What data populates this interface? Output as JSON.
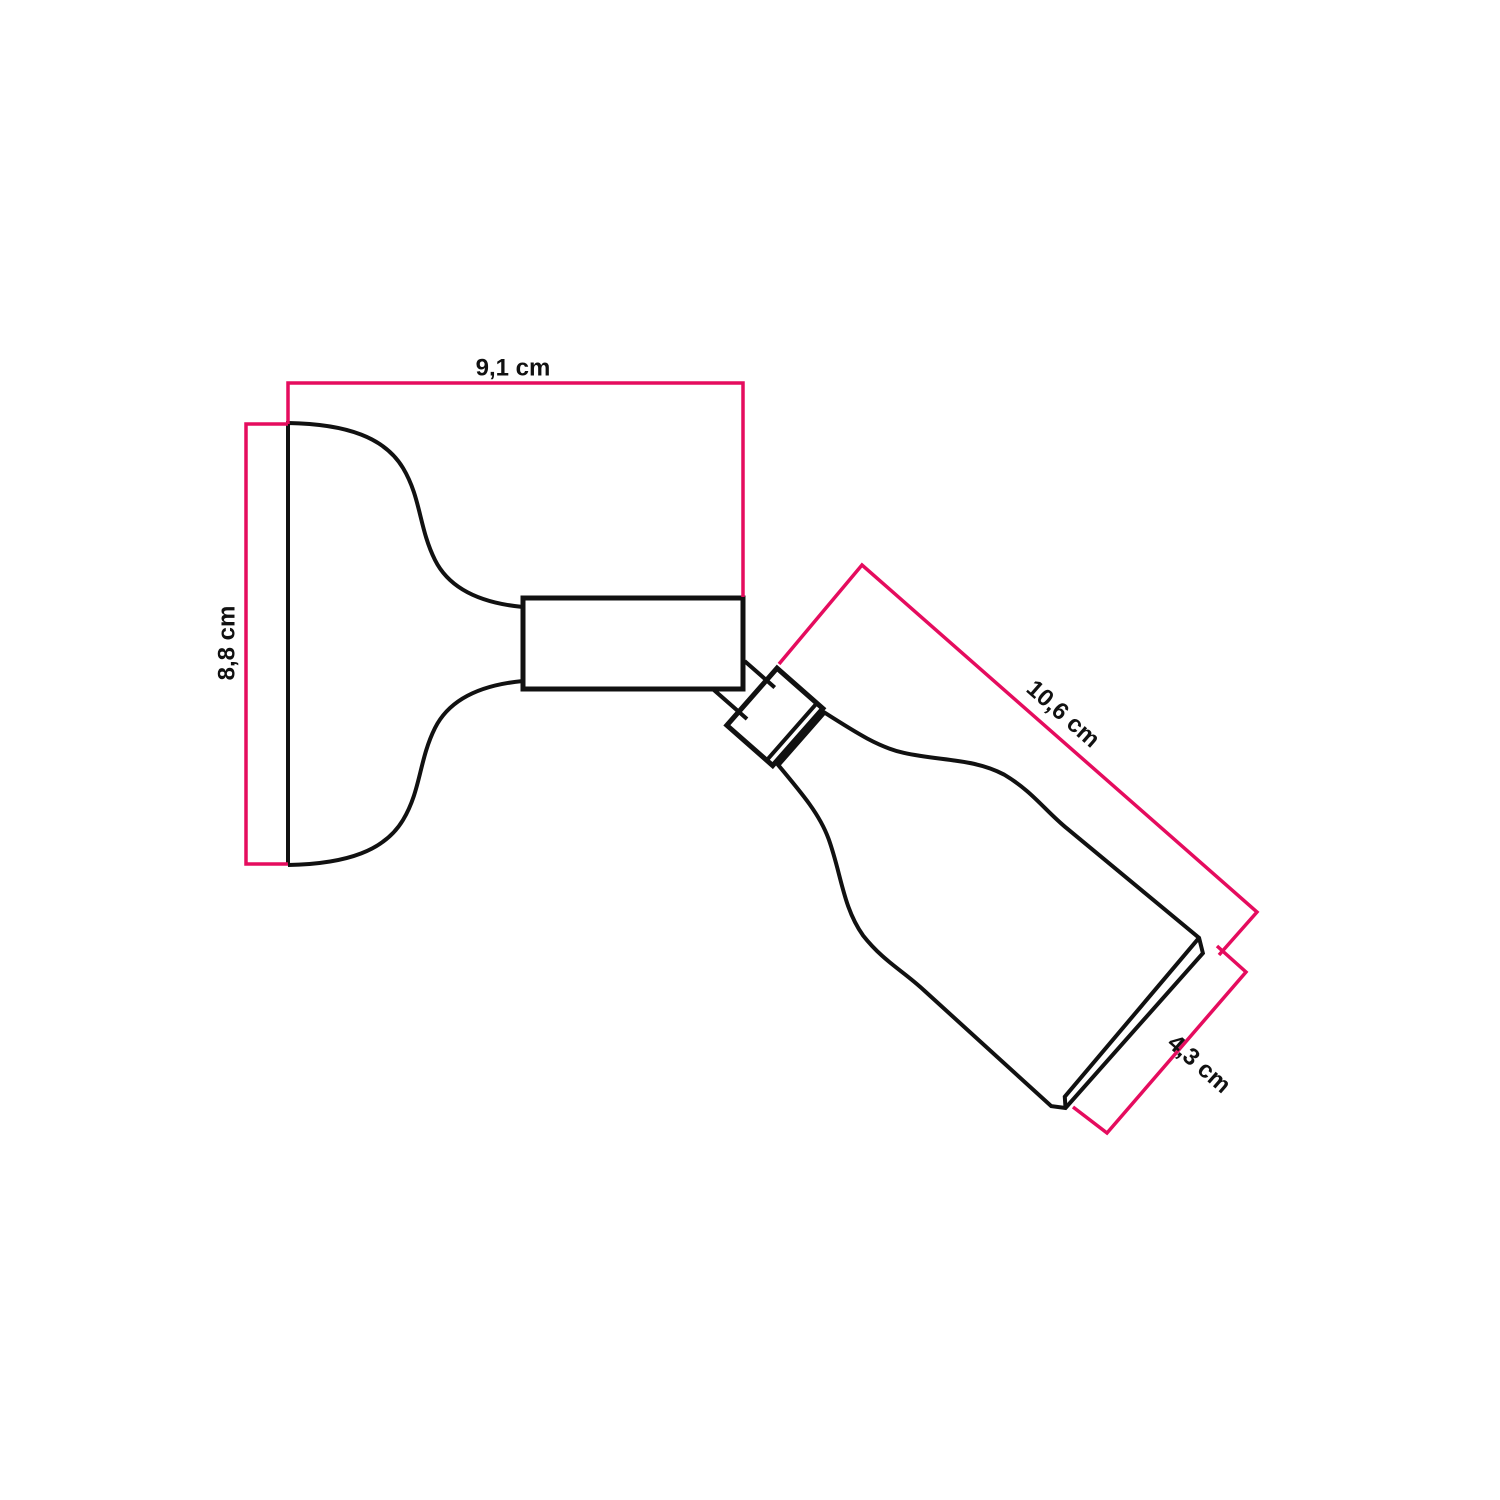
{
  "page": {
    "background": "#ffffff"
  },
  "drawing": {
    "subject": "wall-mounted adjustable spotlight lamp technical dimension drawing",
    "line_color": "#111111",
    "fill_color": "#ffffff"
  },
  "dimensions": {
    "line_color": "#e50c5e",
    "unit": "cm",
    "base_width": {
      "label": "9,1 cm",
      "value": "9,1"
    },
    "base_height": {
      "label": "8,8 cm",
      "value": "8,8"
    },
    "body_length": {
      "label": "10,6 cm",
      "value": "10,6"
    },
    "body_diameter": {
      "label": "4,3 cm",
      "value": "4,3"
    }
  }
}
